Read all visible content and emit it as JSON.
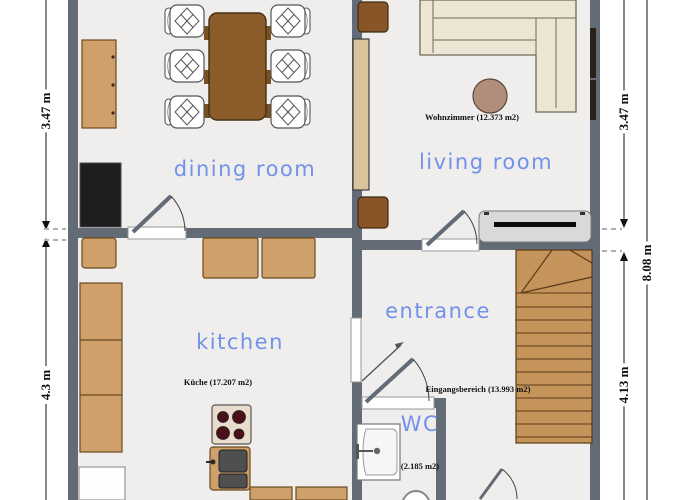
{
  "plan": {
    "rooms": [
      {
        "id": "dining-room",
        "label": "dining room"
      },
      {
        "id": "living-room",
        "label": "living room"
      },
      {
        "id": "kitchen",
        "label": "kitchen"
      },
      {
        "id": "entrance",
        "label": "entrance"
      },
      {
        "id": "wc",
        "label": "WC"
      }
    ],
    "area_labels": [
      {
        "id": "living-room-area",
        "text": "Wohnzimmer (12.373 m2)"
      },
      {
        "id": "kitchen-area",
        "text": "Küche (17.207 m2)"
      },
      {
        "id": "entrance-area",
        "text": "Eingangsbereich (13.993 m2)"
      },
      {
        "id": "wc-area",
        "text": "(2.185 m2)"
      }
    ],
    "dimensions": {
      "left_top": "3.47 m",
      "left_bottom": "4.3 m",
      "right_top": "3.47 m",
      "right_bottom": "4.13 m",
      "right_total": "8.08 m"
    },
    "colors": {
      "wall": "#636b76",
      "floor": "#efeeec",
      "wood": "#cfa06a",
      "table_brown": "#8a5c2a",
      "stairs": "#c4945a",
      "sofa": "#ede6d4",
      "room_label_blue": "#7191ea",
      "burner_red": "#4a0f1a"
    }
  }
}
